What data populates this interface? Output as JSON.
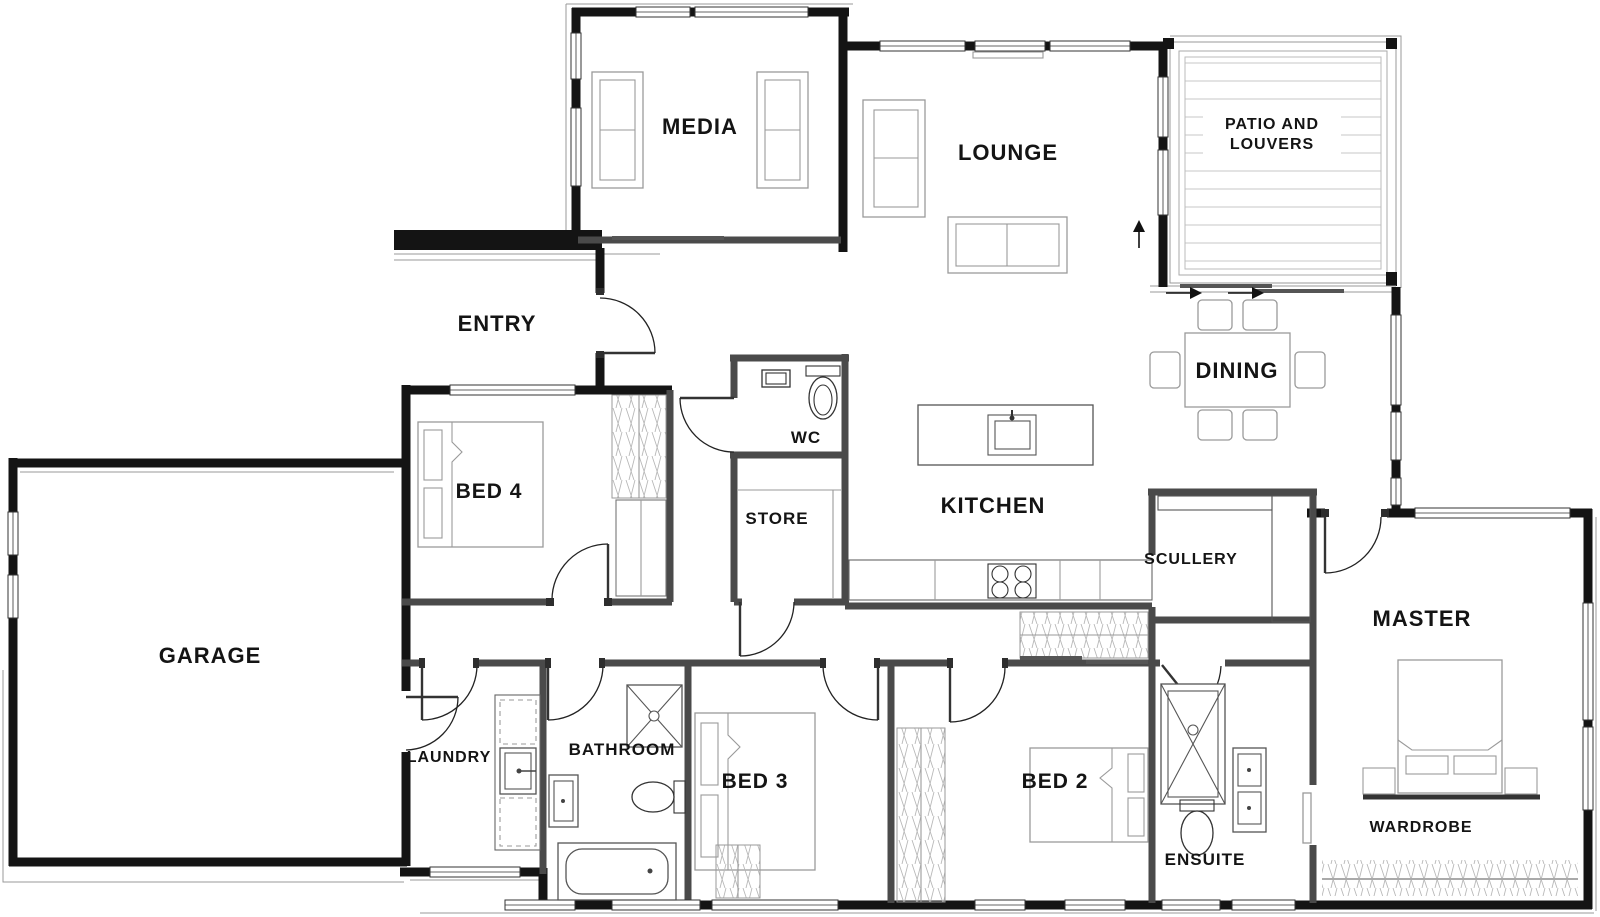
{
  "page": {
    "title": "House Floor Plan",
    "background": "#ffffff"
  },
  "colors": {
    "wall_exterior": "#141414",
    "wall_interior": "#4a4a4a",
    "furniture_line": "#9a9a9a",
    "hatch_line": "#b8b8b8",
    "label_text": "#141414"
  },
  "rooms": {
    "media": {
      "label": "MEDIA"
    },
    "lounge": {
      "label": "LOUNGE"
    },
    "patio": {
      "label_line1": "PATIO AND",
      "label_line2": "LOUVERS"
    },
    "entry": {
      "label": "ENTRY"
    },
    "wc": {
      "label": "WC"
    },
    "dining": {
      "label": "DINING"
    },
    "bed4": {
      "label": "BED 4"
    },
    "store": {
      "label": "STORE"
    },
    "kitchen": {
      "label": "KITCHEN"
    },
    "scullery": {
      "label": "SCULLERY"
    },
    "garage": {
      "label": "GARAGE"
    },
    "master": {
      "label": "MASTER"
    },
    "laundry": {
      "label": "LAUNDRY"
    },
    "bathroom": {
      "label": "BATHROOM"
    },
    "bed3": {
      "label": "BED 3"
    },
    "bed2": {
      "label": "BED 2"
    },
    "ensuite": {
      "label": "ENSUITE"
    },
    "wardrobe": {
      "label": "WARDROBE"
    }
  }
}
